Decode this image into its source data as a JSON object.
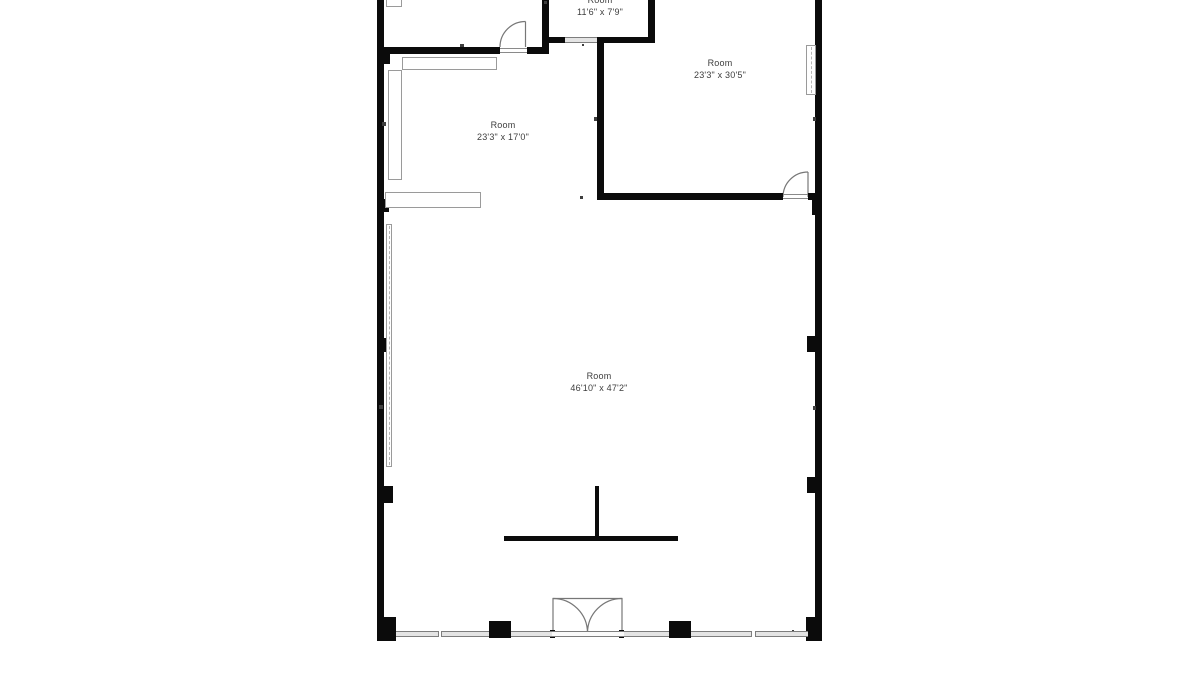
{
  "page": {
    "width": 1200,
    "height": 680,
    "background": "#ffffff"
  },
  "floor_plan": {
    "colors": {
      "wall": "#0b0b0b",
      "tick": "#3f3f3f",
      "fixture_outline": "#9a9a9a",
      "fixture_fill": "#ffffff",
      "window_fill": "#e4e4e4",
      "window_outline": "#7d7d7d",
      "sill_fill": "#fafafa",
      "threshold": "#8a8a8a",
      "dash": "#b5b5b5",
      "door_stroke": "#777777",
      "text": "#3d3d3d"
    },
    "rooms": [
      {
        "name": "Room",
        "dimensions": "11'6\" x 7'9\"",
        "label_x": 600,
        "label_y": -6
      },
      {
        "name": "Room",
        "dimensions": "23'3\" x 30'5\"",
        "label_x": 720,
        "label_y": 57
      },
      {
        "name": "Room",
        "dimensions": "23'3\" x 17'0\"",
        "label_x": 503,
        "label_y": 119
      },
      {
        "name": "Room",
        "dimensions": "46'10\" x 47'2\"",
        "label_x": 599,
        "label_y": 370
      }
    ],
    "geometry": {
      "walls": [
        [
          377,
          0,
          7,
          641
        ],
        [
          815,
          0,
          7,
          641
        ],
        [
          377,
          47,
          123,
          7
        ],
        [
          527,
          47,
          22,
          7
        ],
        [
          542,
          0,
          7,
          54
        ],
        [
          549,
          37,
          16,
          6
        ],
        [
          597,
          37,
          58,
          6
        ],
        [
          648,
          0,
          7,
          43
        ],
        [
          597,
          37,
          7,
          163
        ],
        [
          597,
          193,
          186,
          7
        ],
        [
          808,
          193,
          14,
          7
        ],
        [
          595,
          486,
          4,
          55
        ],
        [
          504,
          536,
          174,
          5
        ],
        [
          377,
          617,
          19,
          24
        ],
        [
          806,
          617,
          16,
          24
        ],
        [
          489,
          621,
          22,
          17
        ],
        [
          669,
          621,
          22,
          17
        ]
      ],
      "piers": [
        [
          377,
          49,
          13,
          15
        ],
        [
          377,
          199,
          12,
          13
        ],
        [
          378,
          338,
          13,
          14
        ],
        [
          379,
          486,
          14,
          17
        ],
        [
          812,
          200,
          10,
          15
        ],
        [
          807,
          336,
          15,
          16
        ],
        [
          807,
          477,
          15,
          16
        ],
        [
          810,
          48,
          12,
          12
        ],
        [
          550,
          630,
          5,
          8
        ],
        [
          619,
          630,
          5,
          8
        ]
      ],
      "ticks": [
        [
          382,
          122,
          4,
          4
        ],
        [
          379,
          405,
          4,
          4
        ],
        [
          813,
          117,
          3,
          4
        ],
        [
          813,
          406,
          3,
          4
        ],
        [
          580,
          196,
          3,
          3
        ],
        [
          582,
          44,
          2,
          2
        ],
        [
          792,
          630,
          2,
          2
        ],
        [
          460,
          44,
          4,
          3
        ],
        [
          594,
          117,
          3,
          4
        ],
        [
          544,
          1,
          3,
          3
        ]
      ],
      "counters": [
        [
          386,
          -4,
          16,
          11
        ],
        [
          402,
          57,
          95,
          13
        ],
        [
          388,
          70,
          14,
          110
        ],
        [
          385,
          192,
          96,
          16
        ]
      ],
      "strips": [
        [
          386,
          224,
          6,
          243
        ],
        [
          806,
          45,
          10,
          50
        ]
      ],
      "windows": [
        [
          396,
          631,
          93,
          6
        ],
        [
          511,
          631,
          41,
          6
        ],
        [
          624,
          631,
          45,
          6
        ],
        [
          691,
          631,
          117,
          6
        ],
        [
          565,
          37,
          32,
          6
        ]
      ],
      "sills": [
        [
          552,
          631,
          72,
          6
        ]
      ],
      "dividers": [
        [
          438,
          631,
          4,
          6
        ],
        [
          751,
          631,
          5,
          6
        ]
      ],
      "thresholds": [
        [
          500,
          48,
          27,
          1
        ],
        [
          500,
          52,
          27,
          1
        ],
        [
          783,
          194,
          25,
          1
        ],
        [
          783,
          198,
          25,
          1
        ]
      ],
      "door_paths": [
        {
          "kind": "leaf",
          "d": "M525.5 47 L525.5 21.5"
        },
        {
          "kind": "arc",
          "d": "M500 47 A25.5 25.5 0 0 1 525.5 21.5"
        },
        {
          "kind": "leaf",
          "d": "M808 197 L808 172"
        },
        {
          "kind": "arc",
          "d": "M783 197 A25 25 0 0 1 808 172"
        },
        {
          "kind": "frame",
          "d": "M553 636 L553 598.5 L622 598.5 L622 636"
        },
        {
          "kind": "arc",
          "d": "M553 598.5 A34.5 34.5 0 0 1 587.5 633"
        },
        {
          "kind": "arc",
          "d": "M587.5 633 A34.5 34.5 0 0 1 622 598.5"
        }
      ]
    }
  }
}
